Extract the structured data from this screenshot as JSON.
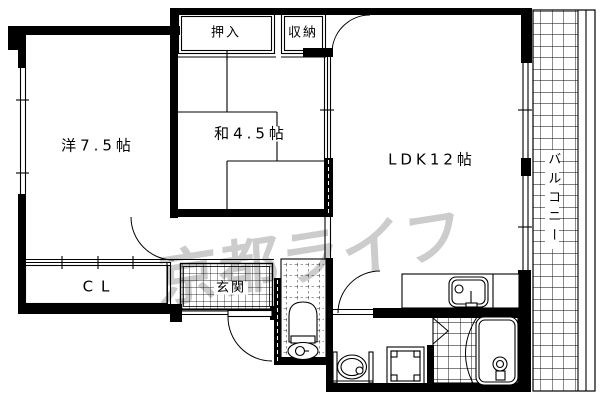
{
  "floor_plan": {
    "labels": {
      "western_room": "洋7.5帖",
      "japanese_room": "和4.5帖",
      "ldk": "LDK12帖",
      "oshiire": "押入",
      "storage": "収納",
      "closet": "CL",
      "entrance": "玄関",
      "balcony": "バルコニー"
    },
    "watermark": "京都ライフ",
    "colors": {
      "line": "#000000",
      "background": "#ffffff",
      "watermark_gray": "#c9c9c9"
    },
    "fixtures": [
      "kitchen-sink",
      "bathtub",
      "toilet",
      "washbasin",
      "washing-machine-pan"
    ]
  }
}
